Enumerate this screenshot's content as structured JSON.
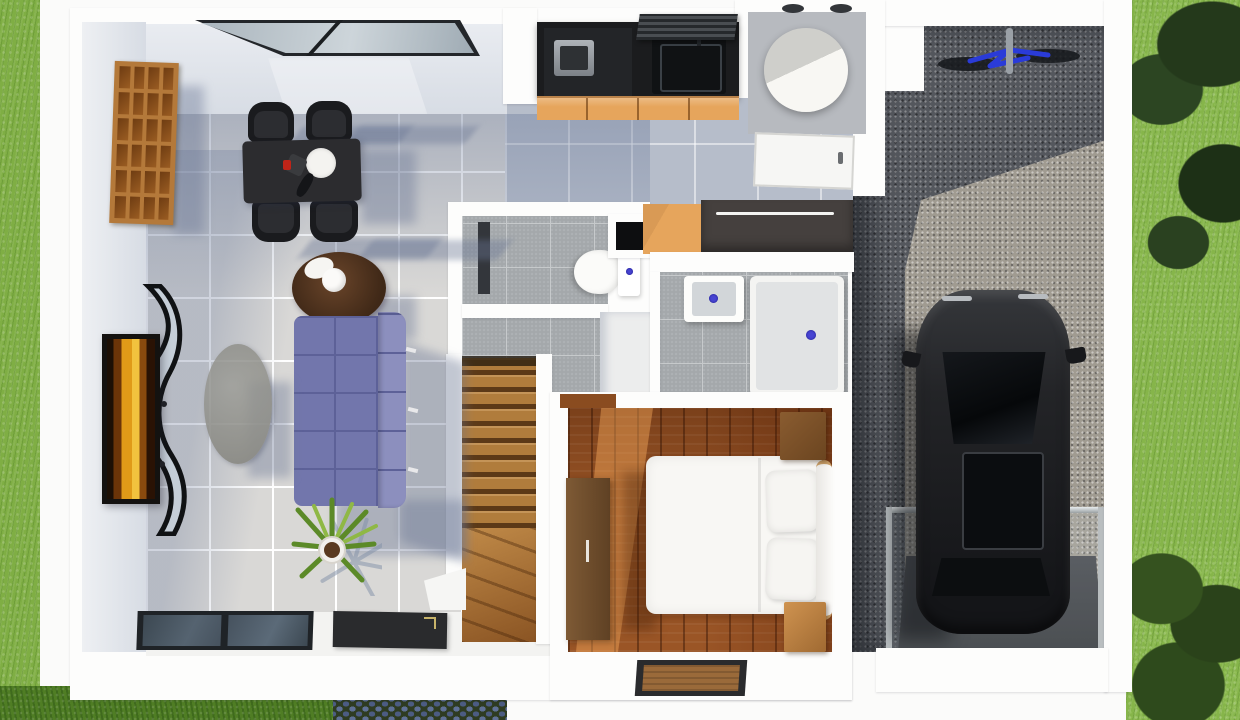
{
  "image": {
    "kind": "3d-top-view-floorplan-render",
    "width_px": 1240,
    "height_px": 720
  },
  "house": {
    "rooms": [
      {
        "name": "living-dining-room",
        "floor": "light-gray-ceramic-tile",
        "furniture": [
          "wood-cube-shelf",
          "dining-table",
          "dining-chairs",
          "round-side-table",
          "sofa",
          "oval-coffee-table",
          "tv-console",
          "wall-picture",
          "potted-plant",
          "black-entry-mat",
          "sliding-glass-window",
          "top-wall-window"
        ],
        "dining_chairs_count": 4,
        "table_items": [
          "white-round-plate",
          "dark-bottle",
          "red-item"
        ]
      },
      {
        "name": "kitchen",
        "furniture": [
          "black-countertop",
          "cooktop-with-pot",
          "range-hood",
          "sink",
          "orange-lower-cabinets"
        ]
      },
      {
        "name": "utility-room",
        "furniture": [
          "white-cylindrical-water-tank",
          "door"
        ]
      },
      {
        "name": "wc",
        "furniture": [
          "toilet-with-cistern",
          "dark-wall-niche"
        ]
      },
      {
        "name": "bathroom",
        "furniture": [
          "square-wash-basin",
          "shower-tray",
          "dark-wardrobe",
          "orange-cabinet"
        ],
        "drain_dots": 3
      },
      {
        "name": "staircase",
        "style": "wood-treads-with-winders",
        "stringers": "white"
      },
      {
        "name": "bedroom",
        "floor": "warm-wood-planks",
        "furniture": [
          "double-bed-white",
          "pillows",
          "nightstands",
          "tall-dresser",
          "brown-doormat"
        ],
        "pillows_count": 2,
        "nightstands_count": 2
      }
    ]
  },
  "garage": {
    "name": "carport",
    "floor": "gravel",
    "contents": [
      "black-car-top-view",
      "blue-bicycle",
      "glass-railing",
      "dark-entry-pad"
    ],
    "car": {
      "color": "black",
      "features": [
        "windshield",
        "sunroof",
        "side-mirrors",
        "rear-window"
      ]
    }
  },
  "exterior": [
    "lawn-left",
    "lawn-bottom",
    "cobblestone-path",
    "lawn-right",
    "tree-canopy",
    "hedge"
  ],
  "palette": {
    "wall-white": "#fdfdfc",
    "wall-face": "#d7dce4",
    "tile": "#d9d8d6",
    "tile-grout": "#ffffff",
    "tile-shadow": "#b6bdca",
    "mosaic": "#a4a8ab",
    "mosaic-grout": "#c6c9cb",
    "wood-stair": "#b07c3c",
    "wood-floor": "#9a5526",
    "wood-shelf": "#b4793a",
    "counter-black": "#1b1c1e",
    "cabinet-orange": "#e6a55c",
    "furniture-black": "#1a1b1e",
    "sofa": "#7276ac",
    "sofa-dark": "#5d6198",
    "sofa-light": "#8c8fbe",
    "table-gray": "#8b8b86",
    "round-table": "#3f2817",
    "grass": "#86b54a",
    "grass-deep": "#4f7d24",
    "tree": "#24391b",
    "hedge": "#35521f",
    "gravel": "#54575d",
    "gravel-light": "#a09b91",
    "car-body": "#232427",
    "car-glass": "#0b0d10",
    "blue-accent": "#4845d2",
    "bike-blue": "#2a3bd8",
    "glass-window": "#47545f",
    "frame-dark": "#141210",
    "art-amber": "#e09a18",
    "cylinder-shade": "#cfcfcb",
    "door-mat-brown": "#9a6a3a",
    "mat-black": "#2a2b2d",
    "shadow-blue": "rgba(104,117,148,0.40)"
  }
}
